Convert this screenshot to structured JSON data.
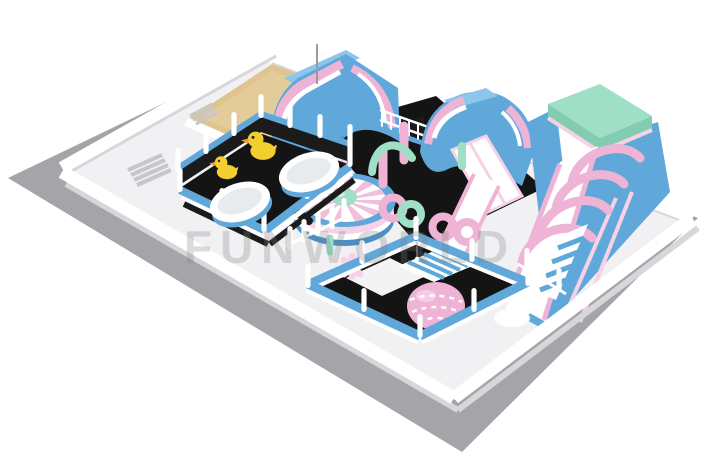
{
  "watermark": {
    "text": "FUNWORLD"
  },
  "palette": {
    "bg": "#ffffff",
    "shadowGray": "#a5a5a9",
    "platform": "#f1f1f4",
    "wallShade": "#d6d6db",
    "stepGray": "#c6c6cc",
    "floorBlack": "#141414",
    "meshBlack": "#1b1b1b",
    "sand": "#dfc48f",
    "sandLight": "#ead7a8",
    "blue": "#60a8da",
    "blueLight": "#8cc6ea",
    "blueDark": "#4b8fc3",
    "pink": "#efb3d6",
    "pinkLight": "#f7d1e6",
    "mint": "#9fdfc6",
    "mintDark": "#82cdb2",
    "duckYellow": "#f2ce2e",
    "duckOrange": "#ee9d2f",
    "tubInner": "#e8ebee",
    "poleGray": "#9a9aa0",
    "watermarkGray": "#7d7d82"
  }
}
